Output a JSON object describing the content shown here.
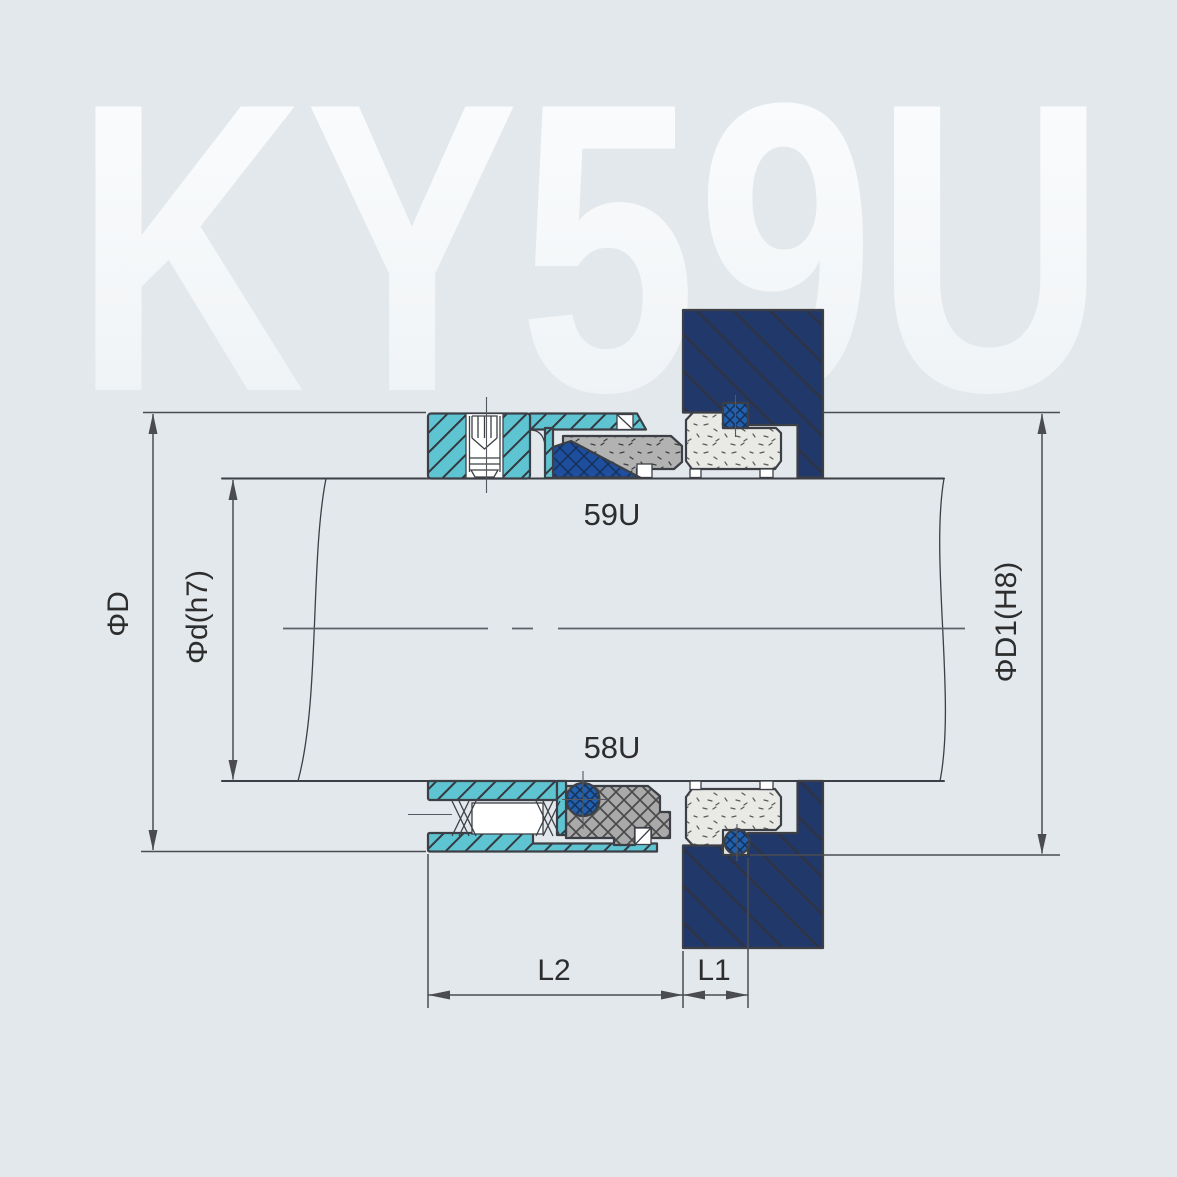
{
  "watermark": "KY59U",
  "labels": {
    "upper_variant": "59U",
    "lower_variant": "58U"
  },
  "dimensions": {
    "outer_diameter": "ΦD",
    "shaft_diameter": "Φd(h7)",
    "bore_diameter": "ΦD1(H8)",
    "working_length": "L2",
    "seat_length": "L1"
  },
  "colors": {
    "background": "#e3e8ec",
    "watermark_top": "#fbfdfe",
    "watermark_bottom": "#edf1f4",
    "outline": "#3c4046",
    "dimension": "#4a4c52",
    "label_text": "#2d2d2d",
    "cyan_metal": "#5fc4d2",
    "navy_gland": "#21386b",
    "blue_elastomer": "#1d4f9e",
    "blue_oring": "#2160ae",
    "gray_face": "#b2b2b2",
    "gray_bellows": "#a9a9a9",
    "seat_light": "#e9e9e5"
  }
}
